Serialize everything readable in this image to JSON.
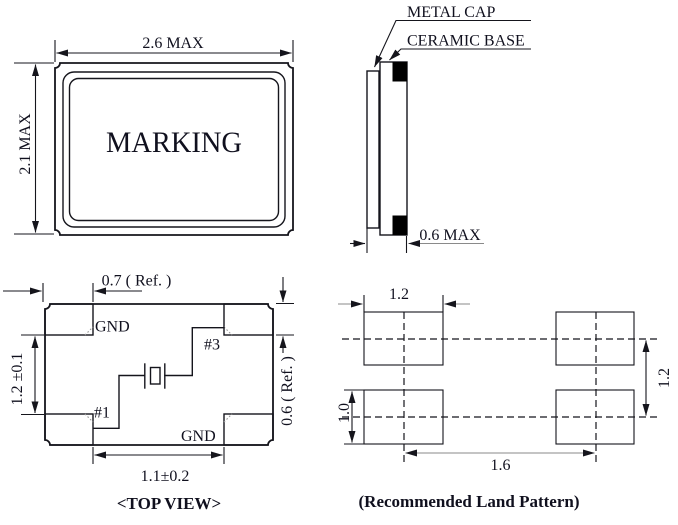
{
  "front_view": {
    "marking_label": "MARKING",
    "dim_width": "2.6 MAX",
    "dim_height": "2.1 MAX"
  },
  "side_view": {
    "metal_cap_label": "METAL CAP",
    "ceramic_base_label": "CERAMIC BASE",
    "dim_thickness": "0.6 MAX"
  },
  "top_view": {
    "caption": "<TOP VIEW>",
    "pad_top_left_label": "GND",
    "pad_bottom_right_label": "GND",
    "pin1_label": "#1",
    "pin3_label": "#3",
    "dim_pad_width": "0.7 ( Ref. )",
    "dim_inner_vertical": "1.2 ±0.1",
    "dim_pad_height": "0.6 ( Ref. )",
    "dim_inner_horizontal": "1.1±0.2"
  },
  "land_pattern": {
    "caption": "(Recommended Land Pattern)",
    "dim_pad_width": "1.2",
    "dim_pad_height": "1.0",
    "dim_row_pitch": "1.2",
    "dim_col_pitch": "1.6"
  },
  "colors": {
    "line": "#15151c",
    "land_pad_fill": "#d4d4d4",
    "terminal_fill": "#000000"
  }
}
